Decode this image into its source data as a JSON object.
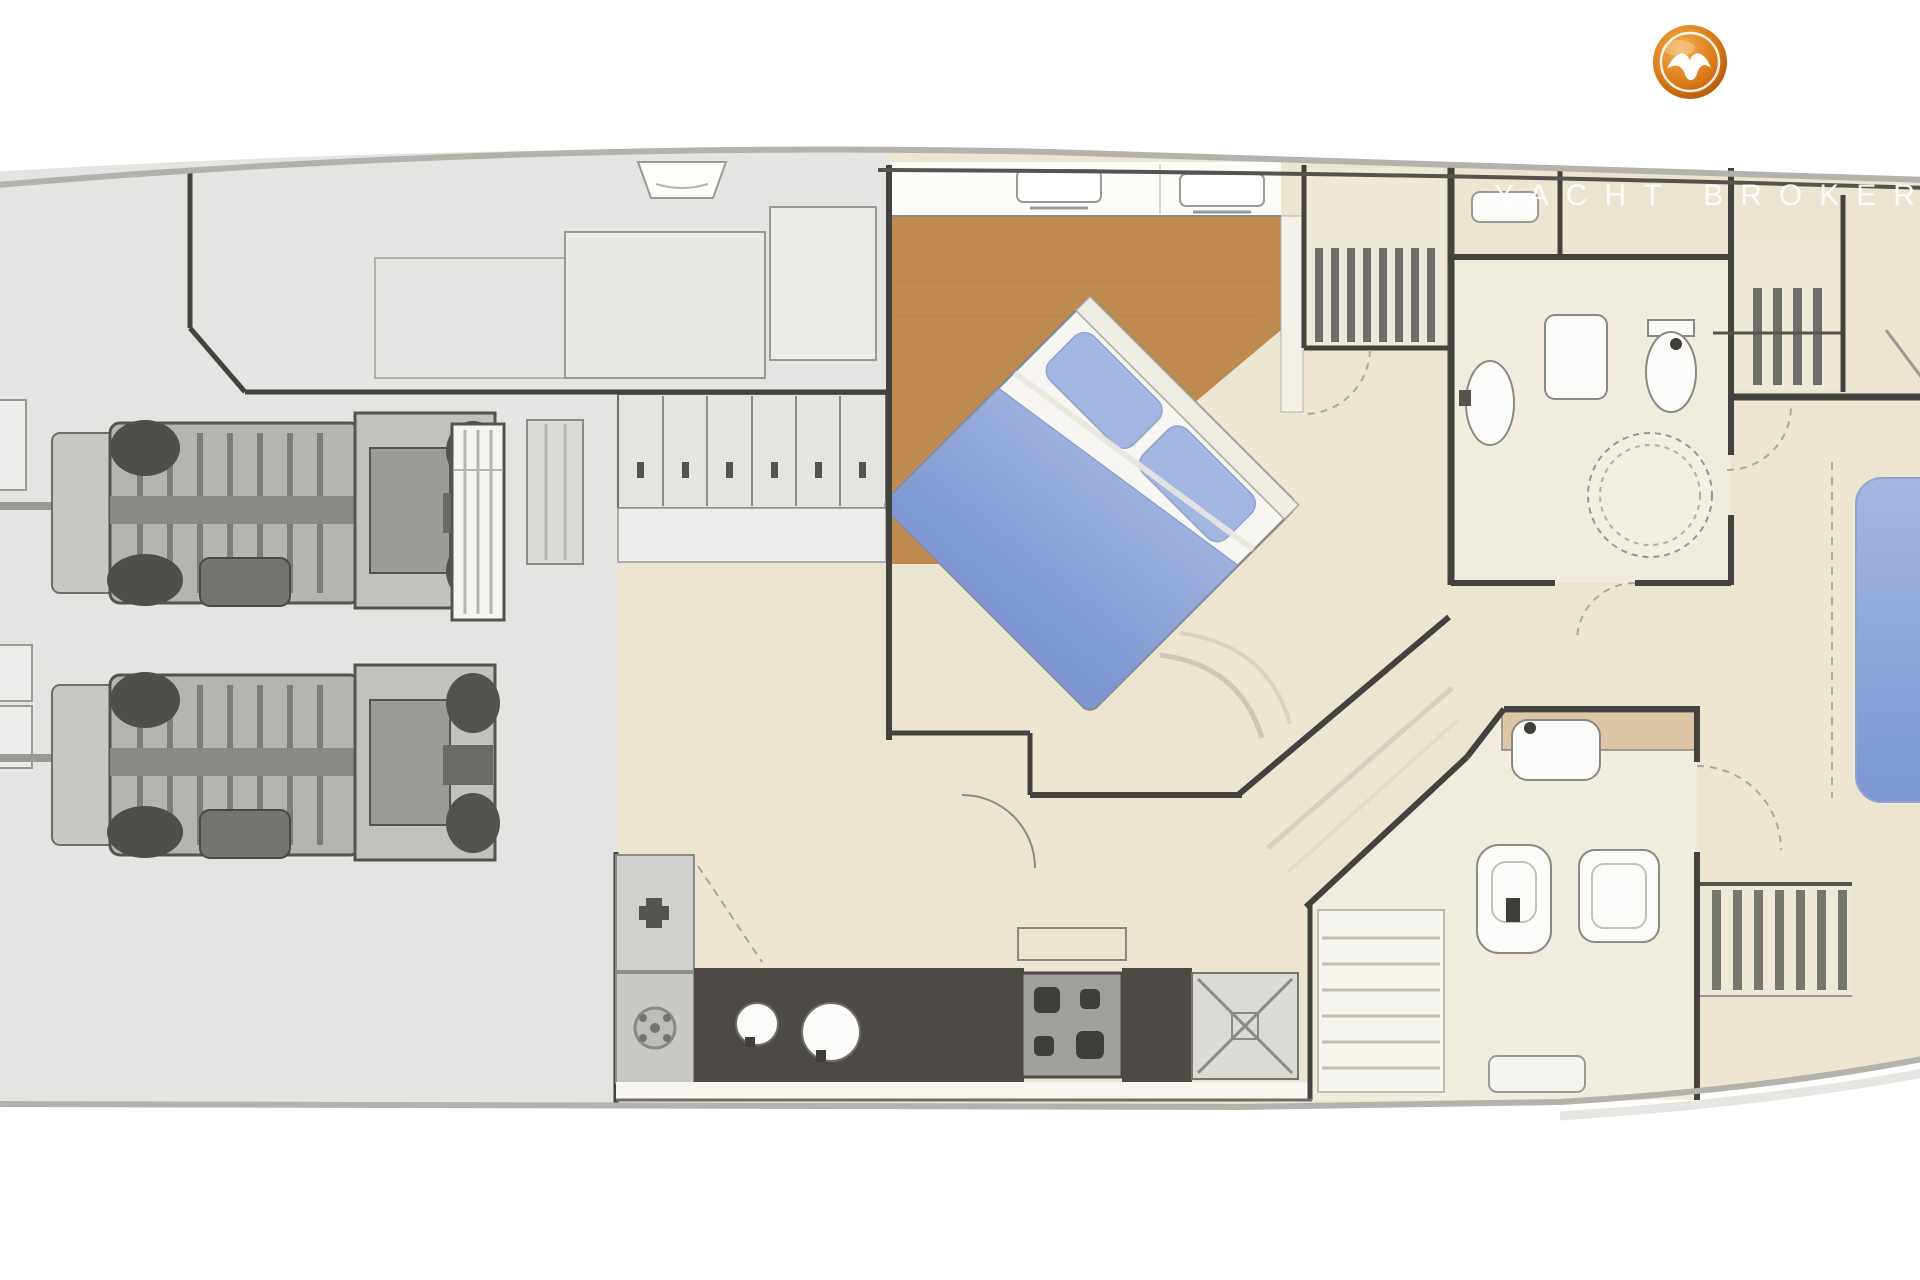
{
  "watermark": {
    "text": "YACHT BROKERS"
  },
  "logo": {
    "icon": "seagull-icon",
    "shape": "circular-badge"
  },
  "palette": {
    "floor_beige": "#ece5d2",
    "floor_gray": "#e4e4e2",
    "wood_floor": "#bf8a50",
    "bathroom_floor": "#f1ece0",
    "wall_dark": "#44423e",
    "counter_dark": "#4e4b46",
    "appliance_gray": "#a2a09b",
    "fixture_white": "#fbfbf9",
    "bed_blue_light": "#a3b6e2",
    "bed_blue_dark": "#7e97d2",
    "counter_tan": "#dcc6a5",
    "logo_orange_light": "#f6b04e",
    "logo_orange_dark": "#b35708",
    "watermark_white": "#ffffff",
    "hull_outline": "#b3b2ad"
  },
  "plan": {
    "regions": [
      "engine-room",
      "fore-platforms",
      "locker-row",
      "master-cabin",
      "stairwell-main",
      "galley",
      "bathroom-forward",
      "bathroom-aft",
      "stairs-aft",
      "aft-cabin"
    ],
    "engine_count": 2,
    "bed_count": 2
  }
}
